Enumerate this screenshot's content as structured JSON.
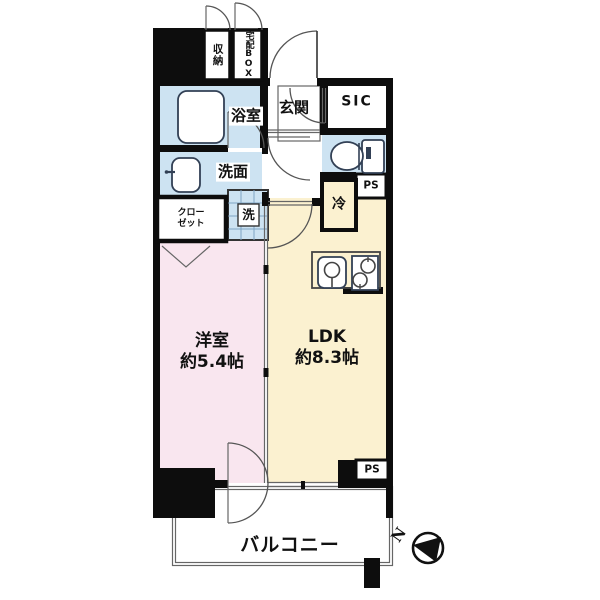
{
  "floorplan": {
    "labels": {
      "storage": "収納",
      "delivery_box": "宅配BOX",
      "entrance": "玄関",
      "shoe_closet": "SIC",
      "pipe_space_top": "PS",
      "pipe_space_bottom": "PS",
      "refrigerator": "冷",
      "bathroom": "浴室",
      "washroom": "洗面",
      "washer": "洗",
      "closet_line1": "クロー",
      "closet_line2": "ゼット",
      "western_room_name": "洋室",
      "western_room_size": "約5.4帖",
      "ldk_name": "LDK",
      "ldk_size": "約8.3帖",
      "balcony": "バルコニー",
      "compass_north": "N"
    },
    "colors": {
      "water_area": "#cde3f2",
      "ldk_floor": "#fbf1d0",
      "bedroom_floor": "#f9e6ef",
      "wall": "#0d0d0d"
    }
  }
}
